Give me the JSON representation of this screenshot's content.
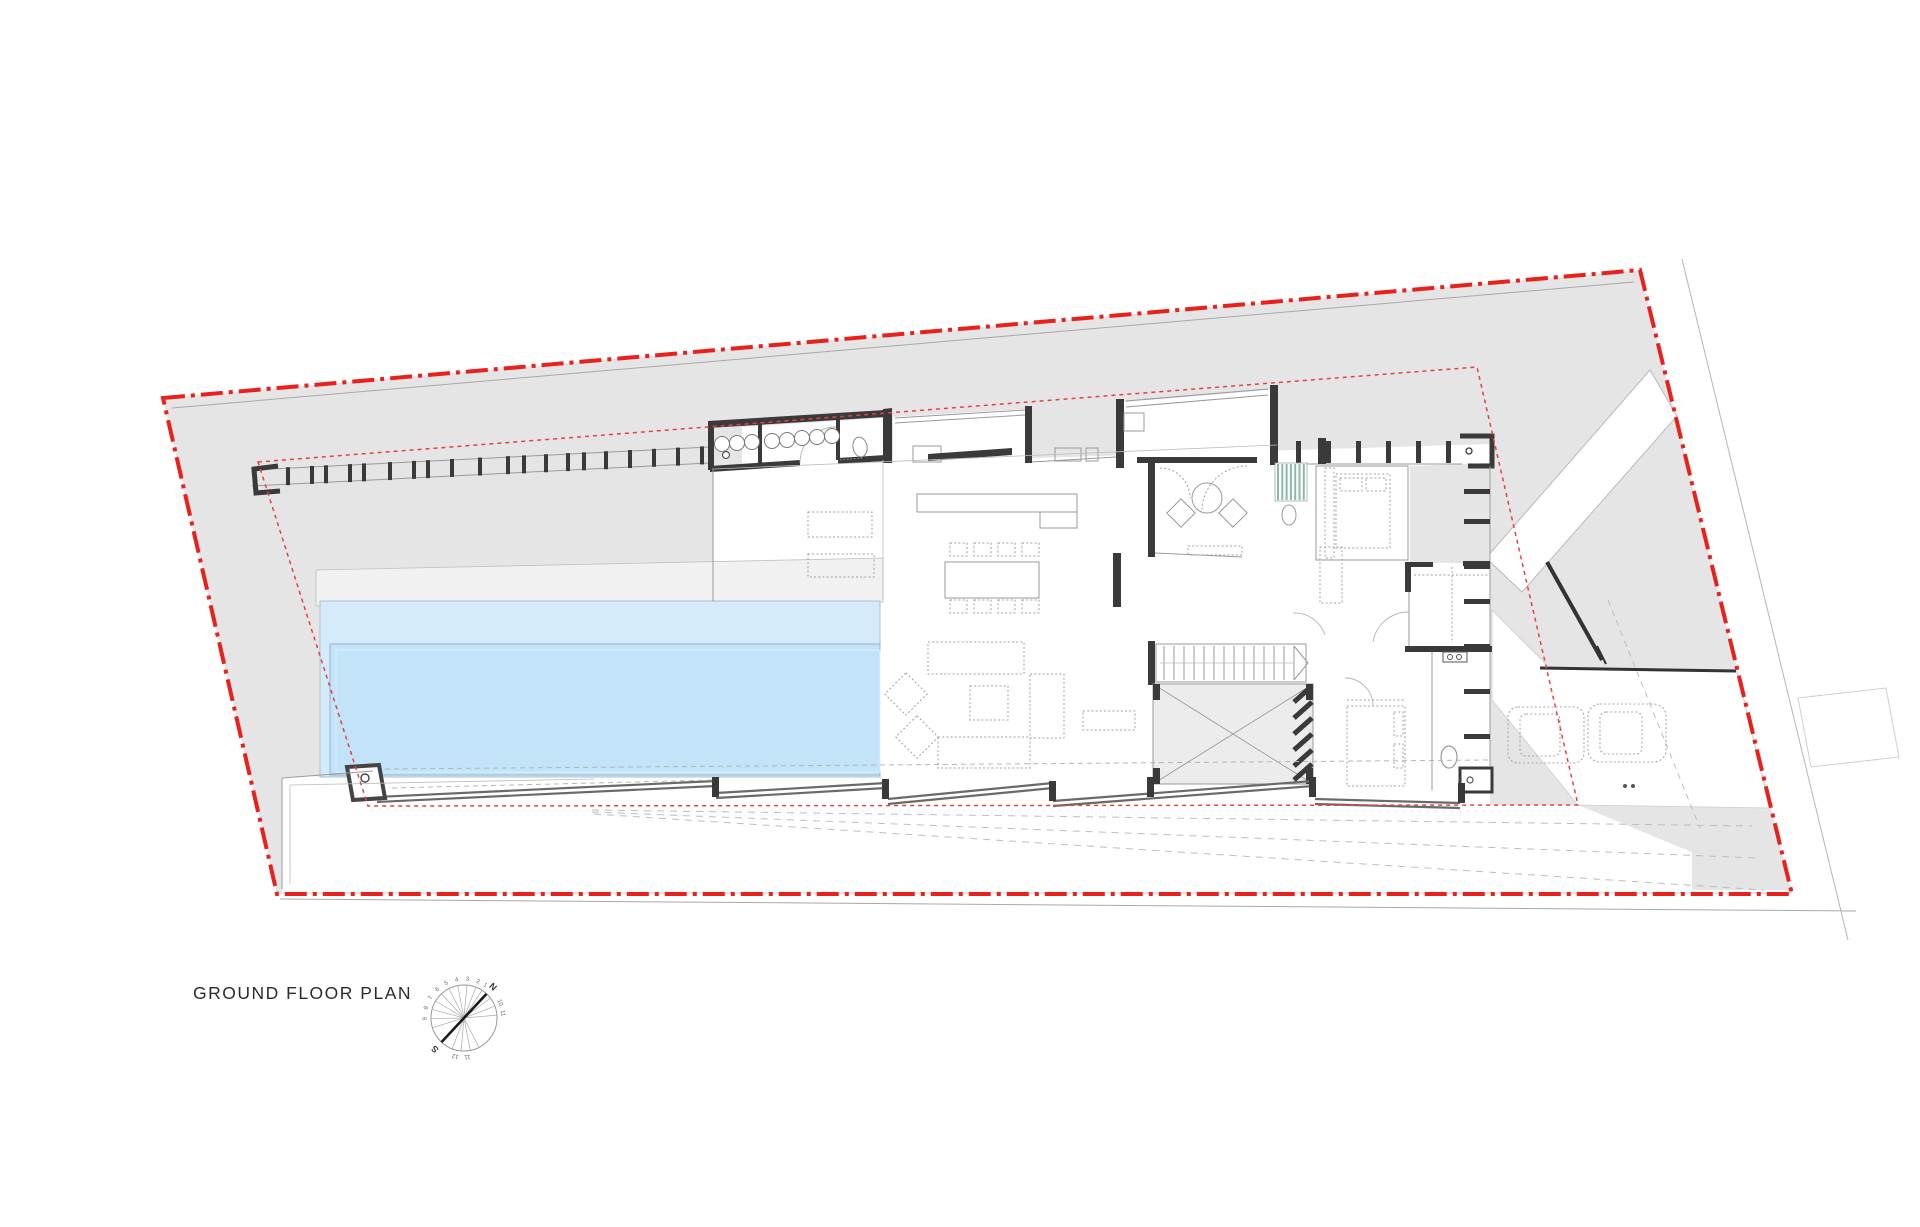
{
  "title": {
    "text": "GROUND FLOOR PLAN"
  },
  "colors": {
    "site_gray": "#e5e5e5",
    "boundary_red": "#e8211d",
    "setback_red": "#e8413d",
    "wall_dark": "#3a3a3a",
    "line_gray": "#9a9a9a",
    "pool_upper": "#d4ebfa",
    "pool_main": "#c3e3f8",
    "pool_edge": "#95b8d2",
    "void_gray": "#ececec",
    "deck_gray": "#f1f1f1",
    "green_wall": "#8fb7a7",
    "text_dark": "#2b2b2b"
  },
  "compass": {
    "center": {
      "x": 464,
      "y": 1018
    },
    "radius": 33,
    "needle": {
      "from": 227,
      "to": 47
    },
    "spoke_angles": [
      5,
      21,
      37,
      57,
      69,
      85,
      101,
      117,
      133,
      149,
      165,
      181,
      197,
      249,
      265,
      281,
      297
    ],
    "labels": [
      {
        "angle": 47,
        "text": "N",
        "major": true
      },
      {
        "angle": 227,
        "text": "S",
        "major": true
      },
      {
        "angle": 57,
        "text": "1"
      },
      {
        "angle": 69,
        "text": "2"
      },
      {
        "angle": 85,
        "text": "3"
      },
      {
        "angle": 101,
        "text": "4"
      },
      {
        "angle": 117,
        "text": "5"
      },
      {
        "angle": 133,
        "text": "6"
      },
      {
        "angle": 149,
        "text": "7"
      },
      {
        "angle": 165,
        "text": "8"
      },
      {
        "angle": 181,
        "text": "9"
      },
      {
        "angle": 23,
        "text": "10"
      },
      {
        "angle": 7,
        "text": "11"
      },
      {
        "angle": 257,
        "text": "12"
      },
      {
        "angle": 275,
        "text": "11"
      }
    ]
  },
  "site": {
    "boundary_points": "163,398 1640,270 1792,894 277,894",
    "setback_points": "258,462 1477,367 1578,805 368,806"
  },
  "fence": {
    "x_left": 252,
    "x_right": 710,
    "y_left": 470,
    "slope": -0.0502,
    "post_xs": [
      288,
      312,
      326,
      350,
      364,
      390,
      414,
      428,
      452,
      480,
      508,
      524,
      546,
      568,
      584,
      606,
      630,
      654,
      678,
      702
    ]
  },
  "service_wing": {
    "circle_radius": 7.5,
    "circles": [
      [
        722,
        444
      ],
      [
        737,
        443
      ],
      [
        752,
        442
      ],
      [
        772,
        441
      ],
      [
        787,
        440
      ],
      [
        802,
        438
      ],
      [
        817,
        437
      ],
      [
        832,
        436
      ]
    ]
  },
  "east_fins": {
    "x": 1464,
    "w": 26,
    "h": 5,
    "ys": [
      489,
      519,
      564,
      599,
      644,
      689,
      734
    ]
  },
  "entry_fins": {
    "y": 441,
    "w": 5,
    "h": 22,
    "xs": [
      1296,
      1326,
      1356,
      1386,
      1416,
      1446
    ]
  },
  "stair": {
    "x0": 1164,
    "x1": 1294,
    "step": 10,
    "y0": 646,
    "y1": 680
  },
  "void_hatch_ys": [
    694,
    710,
    726,
    742,
    758,
    772
  ],
  "fan_lines": [
    [
      592,
      810,
      1752,
      826
    ],
    [
      592,
      812,
      1758,
      858
    ],
    [
      594,
      814,
      1764,
      890
    ]
  ],
  "dining": {
    "chair_xs": [
      950,
      974,
      998,
      1022
    ],
    "row1_y": 543,
    "row2_y": 600
  },
  "green_wall_lines": 7
}
